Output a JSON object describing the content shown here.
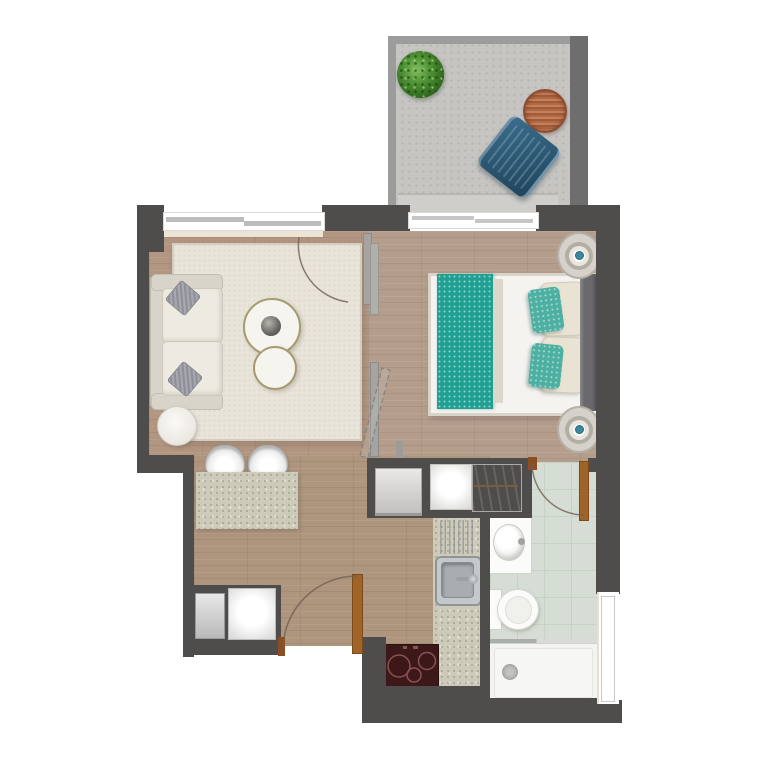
{
  "meta": {
    "title": "Studio apartment floor plan",
    "view": "top-down architectural render",
    "visible_text": "none"
  },
  "colors": {
    "wall": "#4f4c4c",
    "wall-light": "#9c9c9c",
    "balcony-wall-dark": "#6e6e6e",
    "balcony-floor": "#c6c5c2",
    "threshold": "#cfcecb",
    "wood-living": "#b29681",
    "wood-bedroom": "#b59d8c",
    "wood-hall": "#ae957e",
    "rug": "#e9e4da",
    "sofa-base": "#d8d4ca",
    "cushion": "#edebe1",
    "pillow-gray": "#9d9da5",
    "table-rim": "#a69a6e",
    "table-top": "#f6f4ef",
    "sphere-dark": "#4a4643",
    "bed-white": "#f4f3f0",
    "bed-frame": "#d9d4ca",
    "teal": "#1fa093",
    "teal-pillow": "#4db0a2",
    "cream-pillow": "#e9e3d4",
    "bed-strip": "#dcd7ca",
    "headboard": "#69686b",
    "nightstand": "#d6d2cb",
    "lamp-ring": "#b3aea4",
    "lamp-dot": "#3b87a0",
    "speckle-base": "#cdcaba",
    "steel": "#c4c8ca",
    "steel-dark": "#a9adb0",
    "cooktop": "#3c1818",
    "cooktop-ring": "#8a5252",
    "tile": "#d6ddd4",
    "tile-line": "#c8d1c6",
    "fixture-white": "#fbfbf9",
    "fixture-border": "#d2d2ce",
    "door-brown": "#8a4e22",
    "door-leaf": "#a06428",
    "arc": "#6f6051",
    "window-pane": "#bcbcbc",
    "sill": "#ece5d3",
    "glass": "#a9adac"
  },
  "rooms": [
    {
      "name": "balcony",
      "items": [
        "potted-plant",
        "round-wood-table",
        "blue-lounge-chair",
        "threshold-step",
        "railing-walls"
      ]
    },
    {
      "name": "living-room",
      "items": [
        "window",
        "area-rug",
        "sofa",
        "gray-throw-pillow",
        "gray-throw-pillow",
        "round-coffee-table-large-with-bowl",
        "round-coffee-table-small",
        "round-side-table",
        "pocket-door-partition",
        "door-swing-arc"
      ]
    },
    {
      "name": "bedroom",
      "items": [
        "sliding-glass-door-to-balcony",
        "double-bed",
        "teal-runner-blanket",
        "teal-pillow",
        "teal-pillow",
        "cream-pillow",
        "cream-pillow",
        "headboard",
        "nightstand-with-lamp",
        "nightstand-with-lamp"
      ]
    },
    {
      "name": "hallway",
      "items": [
        "dining-counter",
        "white-chair",
        "white-chair",
        "entry-door",
        "utility-closet-appliance",
        "utility-closet-appliance"
      ]
    },
    {
      "name": "storage-row",
      "items": [
        "fridge-cabinet",
        "closet-white-panel",
        "wardrobe-with-hangers"
      ]
    },
    {
      "name": "kitchen",
      "items": [
        "counter",
        "drainboard",
        "stainless-sink",
        "cooktop-with-burners"
      ]
    },
    {
      "name": "bathroom",
      "items": [
        "door",
        "vanity-with-basin",
        "toilet",
        "shower-with-glass-screen",
        "window"
      ]
    }
  ]
}
